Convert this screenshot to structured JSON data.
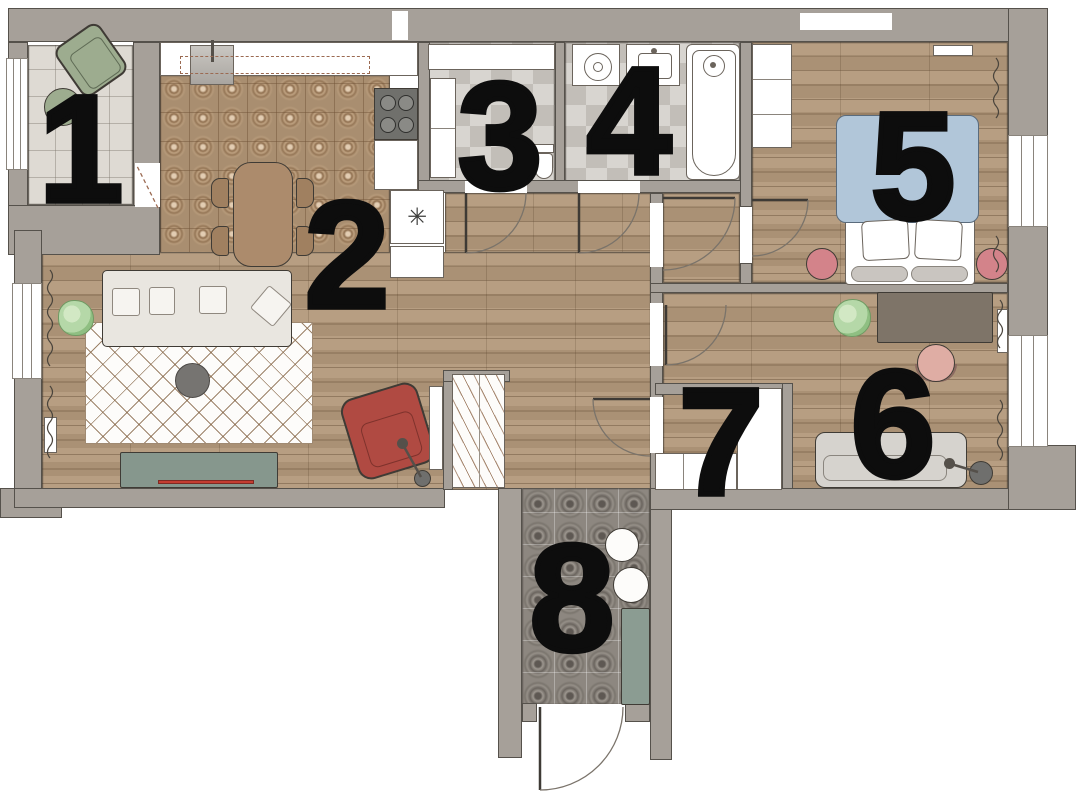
{
  "title": "apartment-floor-plan",
  "rooms": [
    {
      "number": "1",
      "name": "balcony"
    },
    {
      "number": "2",
      "name": "kitchen-living-room"
    },
    {
      "number": "3",
      "name": "toilet"
    },
    {
      "number": "4",
      "name": "bathroom"
    },
    {
      "number": "5",
      "name": "bedroom"
    },
    {
      "number": "6",
      "name": "study-bedroom"
    },
    {
      "number": "7",
      "name": "closet"
    },
    {
      "number": "8",
      "name": "entrance-hall"
    }
  ],
  "icons": {
    "fridge-snowflake": "✳"
  },
  "colors": {
    "wall": "#a6a099",
    "wallLine": "#55514b",
    "wood": "#b3997b",
    "kitchenTile": "#a98e70",
    "balconyFloor": "#dedad3",
    "bathTileA": "#d8d5d0",
    "bathTileB": "#c2beb8",
    "entryTile": "#8d8780",
    "white": "#f7f5f2",
    "sofa": "#e9e6e0",
    "rug": "#fdfcfa",
    "sage": "#9dac8f",
    "console": "#86978d",
    "bench": "#8b9c92",
    "red": "#b04a42",
    "tvRed": "#c43d31",
    "pink": "#d3838a",
    "chairPink": "#dfada4",
    "blue": "#b1c6d9",
    "tableBrown": "#ac8b6c",
    "chairBrown": "#a08060",
    "deskBrown": "#7e7468",
    "darkGray": "#6f6f6d",
    "plant": "#b5d8a8"
  }
}
